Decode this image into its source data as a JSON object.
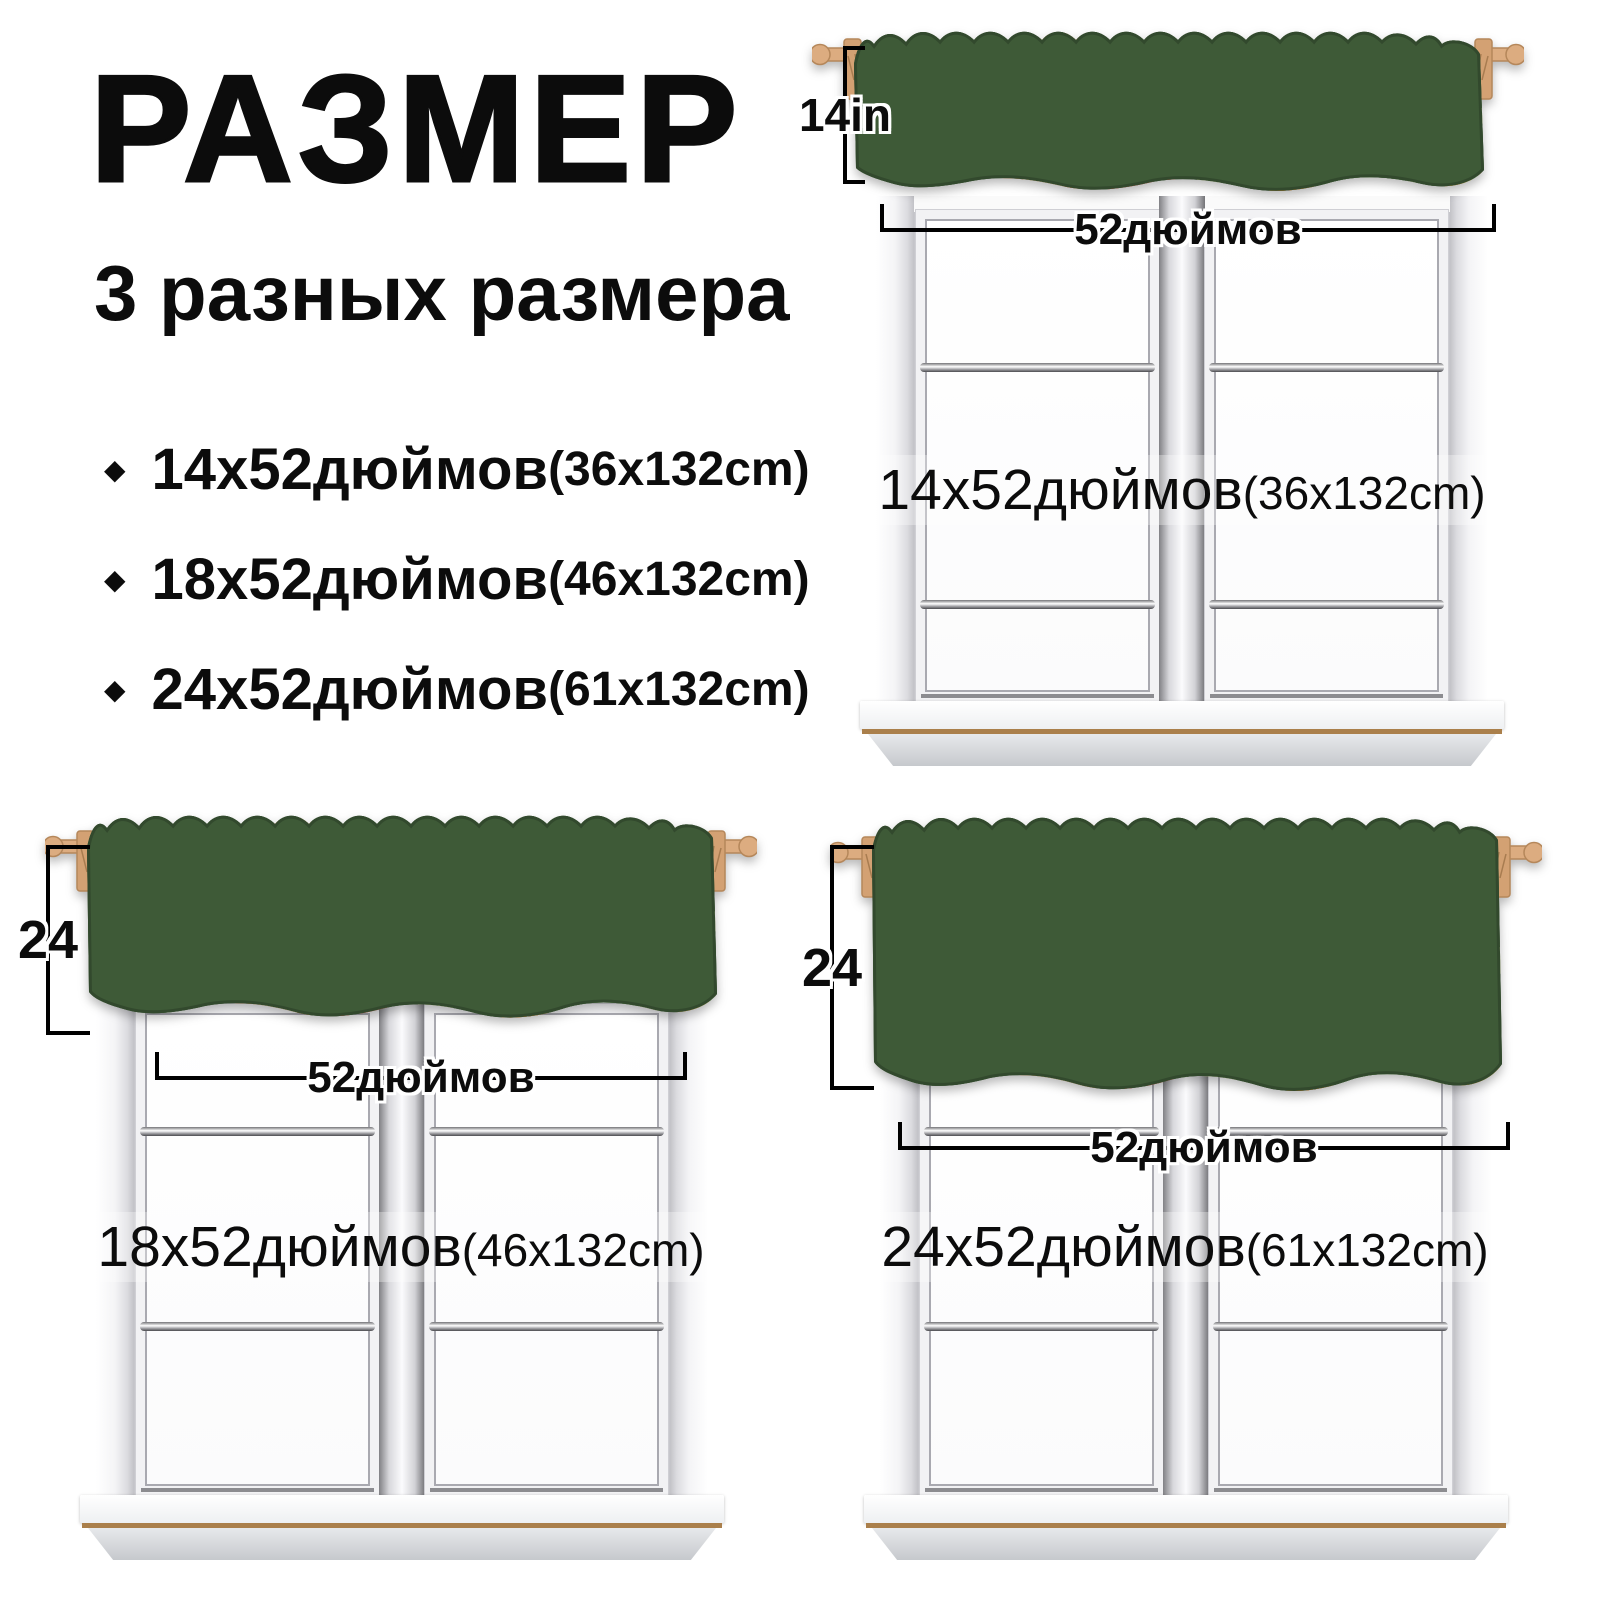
{
  "header": {
    "title": "РАЗМЕР",
    "subtitle": "3 разных размера"
  },
  "icons": {
    "bullet": "◆"
  },
  "sizes": [
    {
      "main": "14х52дюймов",
      "paren": "(36x132cm)"
    },
    {
      "main": "18х52дюймов",
      "paren": "(46x132cm)"
    },
    {
      "main": "24х52дюймов",
      "paren": "(61x132cm)"
    }
  ],
  "windows": [
    {
      "position": "top-right",
      "height_label": "14in",
      "width_label": "52дюймов",
      "label_main": "14х52дюймов",
      "label_paren": "(36x132cm)"
    },
    {
      "position": "bottom-left",
      "height_label": "24",
      "width_label": "52дюймов",
      "label_main": "18х52дюймов",
      "label_paren": "(46x132cm)"
    },
    {
      "position": "bottom-right",
      "height_label": "24",
      "width_label": "52дюймов",
      "label_main": "24х52дюймов",
      "label_paren": "(61x132cm)"
    }
  ],
  "colors": {
    "fabric_green": "#3e5a37",
    "rod_wood": "#dcac80",
    "text": "#0c0c0c",
    "leaf_dark": "#5e8c4a",
    "leaf_light": "#8fbf6f",
    "flower_yellow": "#f4efb6",
    "dragonfruit_red": "#e85a4e",
    "papaya_orange": "#ef9a3c",
    "hippo_gray": "#9a9aa2",
    "monkey_brown": "#b5824f",
    "tiger_orange": "#dd8c50",
    "cat_gray": "#c2c6ca",
    "giraffe_yellow": "#e3aa42",
    "window_frame": "#f2f2f4",
    "sill_wood_line": "#aa7f4b"
  }
}
